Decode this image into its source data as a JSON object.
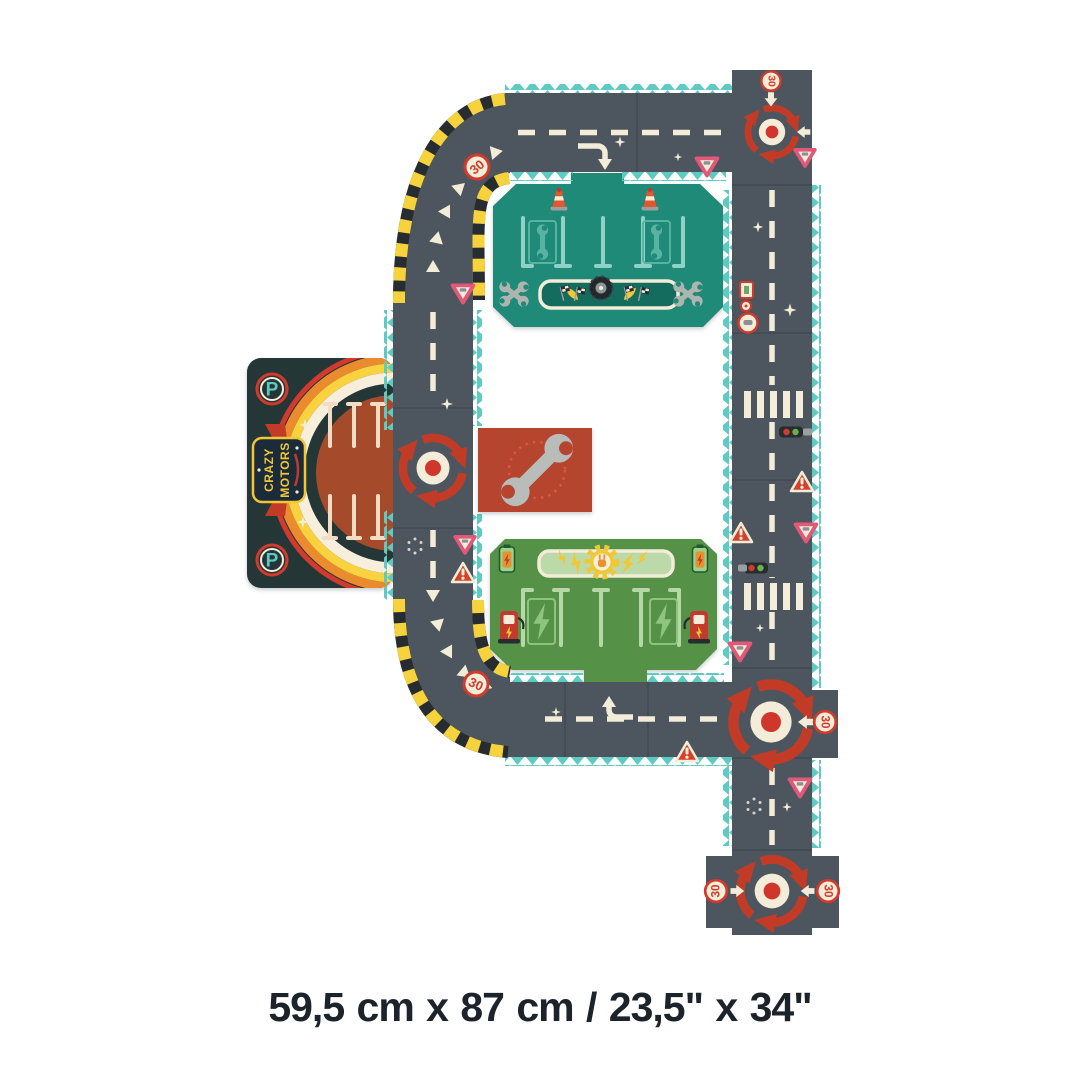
{
  "footer": {
    "dimensions_text": "59,5 cm x 87 cm / 23,5\" x 34\""
  },
  "labels": {
    "speed_limit": "30",
    "parking_letter": "P",
    "badge_line1": "CRAZY",
    "badge_line2": "MOTORS"
  },
  "colors": {
    "background": "#ffffff",
    "road": "#4d565e",
    "edge_teal": "#5ecac2",
    "marking_cream": "#f2ecd8",
    "hazard_yellow": "#f6d23c",
    "hazard_black": "#272c31",
    "roundabout_red": "#c13b27",
    "sign_red": "#d23a2c",
    "sign_pink": "#e25878",
    "garage_teal": "#1f8a77",
    "charging_green": "#559247",
    "service_red": "#b5452e",
    "parking_dark": "#253637",
    "parking_brown": "#a54b2c",
    "badge_navy": "#1c2b3a",
    "caption_text": "#1d232b"
  },
  "icons": {
    "roundabout": "circular-red-arrows",
    "speed_limit_sign": "30-in-red-ring",
    "yield_sign": "inverted-triangle",
    "warning_sign": "exclamation-triangle",
    "traffic_light": "horizontal-red-green-light",
    "crosswalk": "white-bar-stripes",
    "wrench": "spanner",
    "traffic_cone": "orange-white-cone",
    "tire": "racing-tire",
    "checkered_flag": "finish-flag-pair",
    "battery": "charging-battery",
    "charger_pump": "ev-charger",
    "lightning_bolt": "bolt",
    "gear_plug": "electric-plug-gear-emblem",
    "parking_badge": "P-in-ring",
    "sparkle": "four-point-star"
  }
}
